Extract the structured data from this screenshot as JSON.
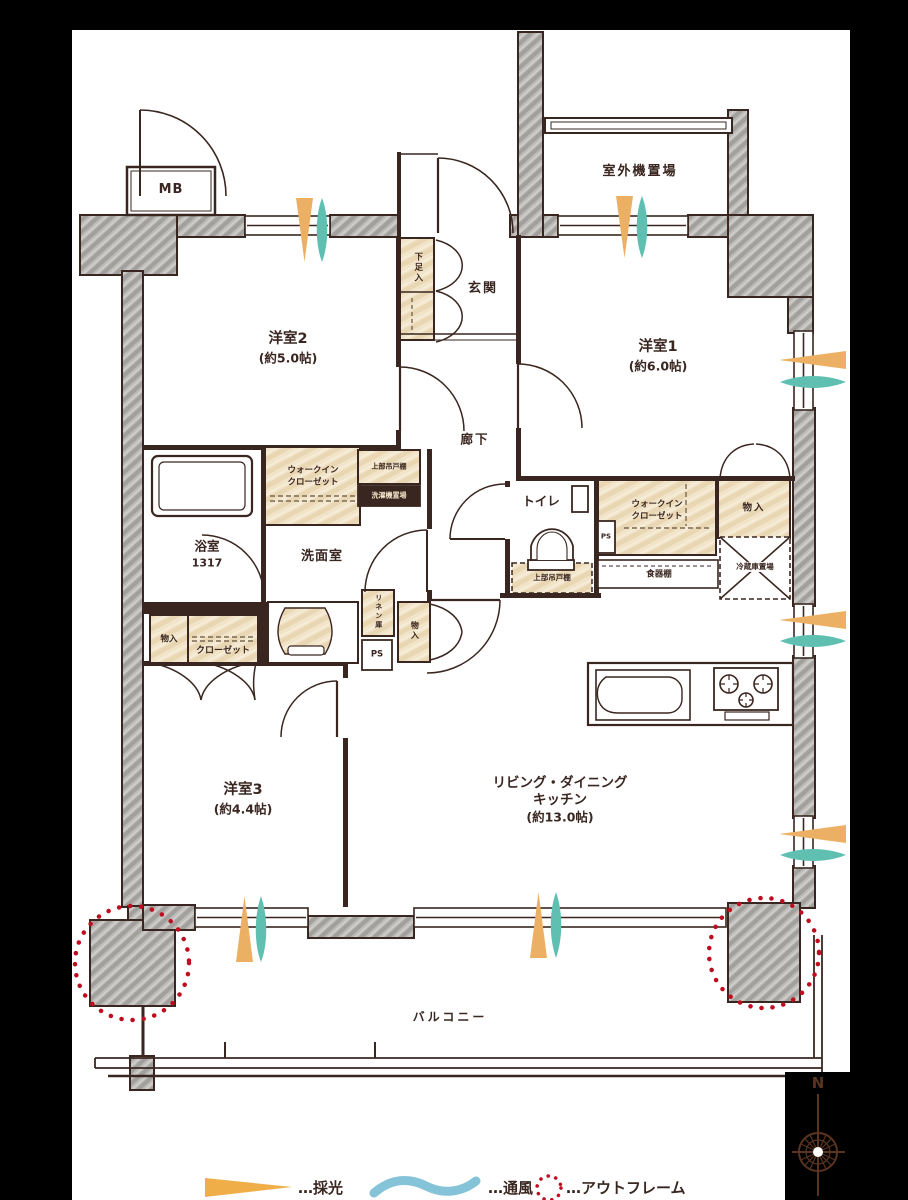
{
  "labels": {
    "mb": "MB",
    "outdoor_unit": "室外機置場",
    "bedroom2_name": "洋室2",
    "bedroom2_size": "(約5.0帖)",
    "bedroom1_name": "洋室1",
    "bedroom1_size": "(約6.0帖)",
    "bedroom3_name": "洋室3",
    "bedroom3_size": "(約4.4帖)",
    "ldk_line1": "リビング・ダイニング",
    "ldk_line2": "キッチン",
    "ldk_size": "(約13.0帖)",
    "entrance": "玄関",
    "hallway": "廊下",
    "shoe_cabinet": "下足入",
    "bathroom_name": "浴室",
    "bathroom_size": "1317",
    "washroom": "洗面室",
    "toilet": "トイレ",
    "wic_line1": "ウォークイン",
    "wic_line2": "クローゼット",
    "upper_cabinet": "上部吊戸棚",
    "washer_space": "洗濯機置場",
    "closet": "クローゼット",
    "storage": "物入",
    "linen": "リネン庫",
    "ps": "PS",
    "cupboard": "食器棚",
    "fridge_space": "冷蔵庫置場",
    "balcony": "バルコニー"
  },
  "legend": {
    "daylight": "…採光",
    "ventilation": "…通風",
    "outframe": "…アウトフレーム"
  },
  "compass": {
    "north": "N"
  },
  "colors": {
    "background": "#000000",
    "paper": "#ffffff",
    "line": "#3a2620",
    "concrete": "#b3b0ac",
    "wood_fill": "#f0e3c8",
    "daylight_arrow": "#ecb064",
    "ventilation_arrow": "#5fc0b2",
    "legend_wave": "#85c3d8",
    "outframe_red": "#bf0d20"
  }
}
